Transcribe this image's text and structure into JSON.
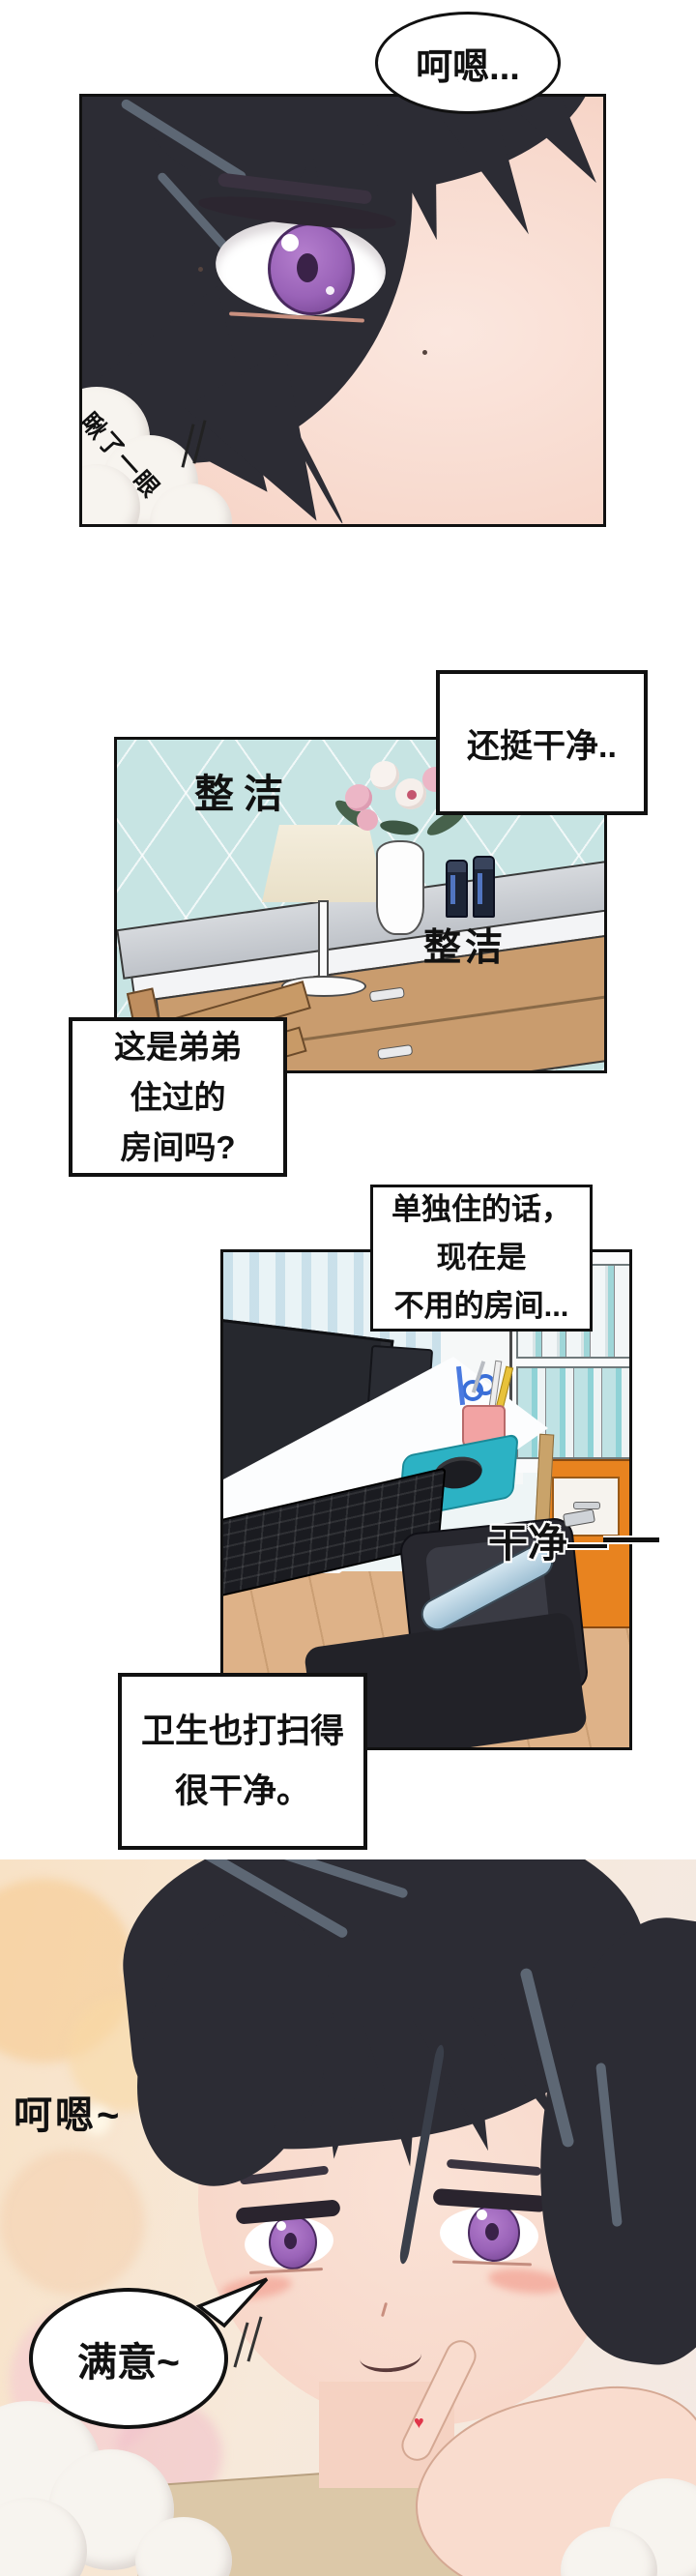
{
  "comic": {
    "panel1": {
      "bubble": "呵嗯...",
      "sfx_glance": "瞅了一眼"
    },
    "panel2": {
      "bubble": "还挺干净..",
      "label_tidy_1": "整洁",
      "label_tidy_2": "整洁"
    },
    "caption1": {
      "lines": [
        "这是弟弟",
        "住过的",
        "房间吗?"
      ]
    },
    "panel3": {
      "bubble_lines": [
        "单独住的话，",
        "现在是",
        "不用的房间..."
      ],
      "sfx_clean": "干净—"
    },
    "caption2": {
      "lines": [
        "卫生也打扫得",
        "很干净。"
      ]
    },
    "panel4": {
      "sfx_hum": "呵嗯~",
      "bubble": "满意~",
      "heart": "♥"
    },
    "colors": {
      "eye_purple": "#9a63b8",
      "wallpaper_teal": "#c7e4e3",
      "mousepad_teal": "#2cb2c4",
      "cabinet_orange": "#e8831f",
      "floor_wood": "#deb288",
      "bokeh_warm": "#f8d9a8",
      "heart_red": "#e0354a"
    }
  }
}
